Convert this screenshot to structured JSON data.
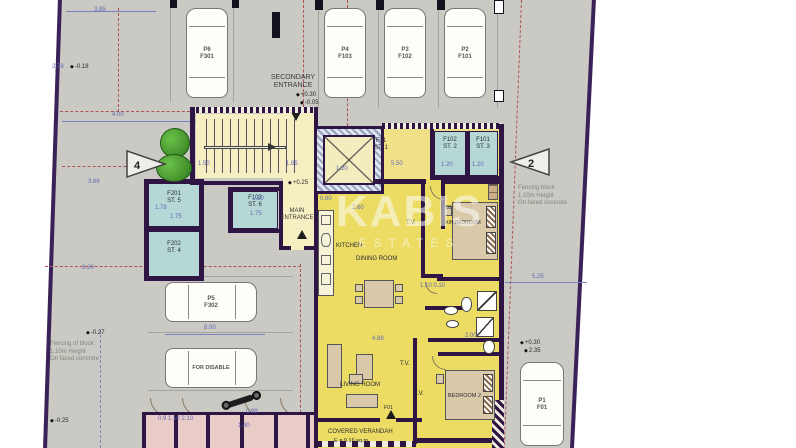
{
  "colors": {
    "boundary": "#3a2158",
    "wall": "#2e1544",
    "apartment_yellow": "#ecdc63",
    "hall_cream": "#f5efc2",
    "storage_teal": "#b5d8d6",
    "plot_gray": "#cac9c3",
    "pink_rooms": "#e9cbc7",
    "dashed_red": "#b05252",
    "dimension_blue": "#5f6ab8",
    "tree_green": "#4a9a30"
  },
  "watermark": {
    "line1": "KABIS",
    "line2": "ESTATES"
  },
  "entrances": {
    "secondary": {
      "line1": "SECONDARY",
      "line2": "ENTRANCE"
    },
    "main": {
      "line1": "MAIN",
      "line2": "ENTRANCE"
    }
  },
  "parking": {
    "top": [
      {
        "space": "P6",
        "flat": "F301"
      },
      {
        "space": "P4",
        "flat": "F103"
      },
      {
        "space": "P3",
        "flat": "F102"
      },
      {
        "space": "P2",
        "flat": "F101"
      }
    ],
    "side": [
      {
        "space": "P5",
        "flat": "F302"
      },
      {
        "space": "FOR DISABLE",
        "flat": ""
      }
    ],
    "bottom_right": {
      "space": "P1",
      "flat": "F01"
    }
  },
  "rooms": {
    "kitchen": "KITCHEN",
    "dining": "DINING ROOM",
    "living": "LIVING ROOM",
    "tv1": "T.V.",
    "tv2": "T.V.",
    "tv3": "T.V.",
    "main_bedroom_no": "03",
    "main_bedroom": "MAIN BEDROOM",
    "bedroom2": "BEDROOM 2",
    "veranda": "COVERED VERANDAH",
    "veranda_area": "E = 9.16 sq.m",
    "door_ref": "F01"
  },
  "storages": [
    {
      "flat": "F201",
      "store": "ST. 5"
    },
    {
      "flat": "F202",
      "store": "ST. 4"
    },
    {
      "flat": "F103",
      "store": "ST. 6"
    },
    {
      "flat": "F01",
      "store": "ST. 1"
    },
    {
      "flat": "F102",
      "store": "ST. 2"
    },
    {
      "flat": "F101",
      "store": "ST. 3"
    }
  ],
  "section_markers": {
    "left": "4",
    "right": "2"
  },
  "notes": {
    "right_fence": [
      "Fencing block",
      "1.10m Height",
      "On faced concrete"
    ],
    "left_fence": [
      "Fencing of block",
      "1.10m Height",
      "On faced concrete"
    ]
  },
  "dim_labels": [
    {
      "t": "3.85",
      "x": 94,
      "y": 7
    },
    {
      "t": "2.78",
      "x": 52,
      "y": 64
    },
    {
      "t": "4.00",
      "x": 112,
      "y": 112
    },
    {
      "t": "3.66",
      "x": 88,
      "y": 179
    },
    {
      "t": "3.20",
      "x": 82,
      "y": 265
    },
    {
      "t": "1.50",
      "x": 198,
      "y": 161
    },
    {
      "t": "1.85",
      "x": 286,
      "y": 161
    },
    {
      "t": "1.20",
      "x": 336,
      "y": 166
    },
    {
      "t": "5.50",
      "x": 391,
      "y": 161
    },
    {
      "t": "1.20",
      "x": 441,
      "y": 162
    },
    {
      "t": "1.20",
      "x": 472,
      "y": 162
    },
    {
      "t": "1.78",
      "x": 155,
      "y": 205
    },
    {
      "t": "1.75",
      "x": 170,
      "y": 214
    },
    {
      "t": "1.75",
      "x": 250,
      "y": 211
    },
    {
      "t": "1.10",
      "x": 252,
      "y": 196
    },
    {
      "t": "0.60",
      "x": 320,
      "y": 196
    },
    {
      "t": "2.60",
      "x": 352,
      "y": 205
    },
    {
      "t": "8.00",
      "x": 204,
      "y": 325
    },
    {
      "t": "5.25",
      "x": 532,
      "y": 274
    },
    {
      "t": "2.00",
      "x": 465,
      "y": 333
    },
    {
      "t": "1.10 0.10",
      "x": 420,
      "y": 283
    },
    {
      "t": "4.88",
      "x": 372,
      "y": 336
    },
    {
      "t": "0.9 1.10 2.10",
      "x": 158,
      "y": 416
    },
    {
      "t": "0.98",
      "x": 246,
      "y": 409
    },
    {
      "t": "1.40",
      "x": 238,
      "y": 423
    }
  ],
  "level_labels": [
    {
      "t": "-0.18",
      "x": 70,
      "y": 64
    },
    {
      "t": "+0.30",
      "x": 296,
      "y": 92
    },
    {
      "t": "-0.05",
      "x": 300,
      "y": 100
    },
    {
      "t": "+0.25",
      "x": 288,
      "y": 180
    },
    {
      "t": "-0.27",
      "x": 86,
      "y": 330
    },
    {
      "t": "-0.25",
      "x": 50,
      "y": 418
    },
    {
      "t": "+0.30",
      "x": 520,
      "y": 340
    },
    {
      "t": "2.35",
      "x": 524,
      "y": 348
    }
  ]
}
